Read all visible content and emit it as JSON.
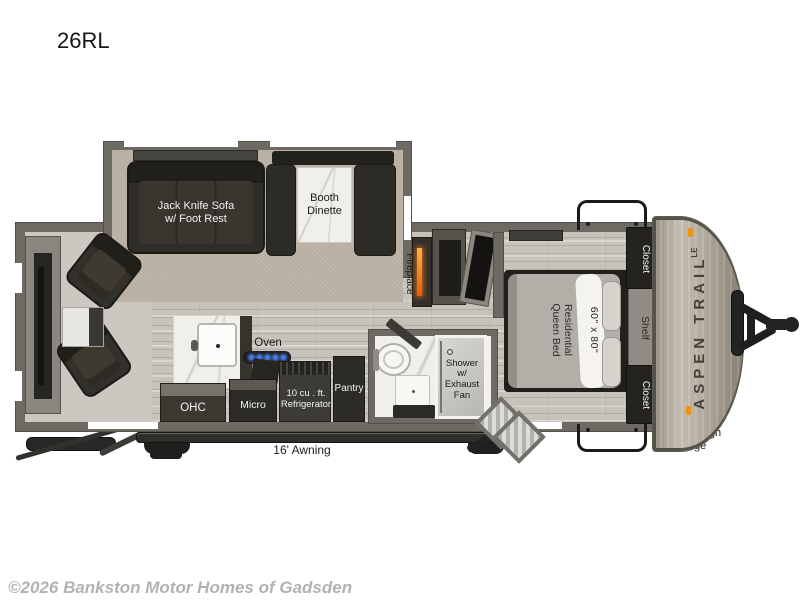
{
  "model": {
    "label": "26RL"
  },
  "footer": {
    "copyright": "©2026 Bankston Motor Homes of Gadsden"
  },
  "colors": {
    "wall_gray": "#6d6a64",
    "floor_wood": "#c8c3ba",
    "carpet_tan": "#b7aea1",
    "furniture_dark": "#2c2b26",
    "counter_marble": "#f1efea",
    "fireplace_glow": "#e85d04",
    "burner_blue": "#3f76e8",
    "front_cap": "#b3ab9e",
    "marker_light": "#f0930f"
  },
  "living": {
    "sofa": "Jack Knife Sofa\nw/ Foot Rest",
    "dinette": "Booth\nDinette",
    "fireplace": "Fireplace"
  },
  "kitchen": {
    "oven": "Oven",
    "ohc": "OHC",
    "micro": "Micro",
    "refrigerator": "10 cu . ft.\nRefrigerator",
    "pantry": "Pantry"
  },
  "bath": {
    "shower": "Shower\nw/\nExhaust\nFan"
  },
  "bedroom": {
    "bed_size": "60\" x 80\"",
    "bed": "Residential\nQueen Bed",
    "closet_top": "Closet",
    "shelf": "Shelf",
    "closet_bottom": "Closet"
  },
  "exterior": {
    "awning": "16' Awning",
    "pass_through": "Pass Through\nStorage",
    "brand": "ASPEN TRAIL",
    "brand_badge": "LE"
  }
}
